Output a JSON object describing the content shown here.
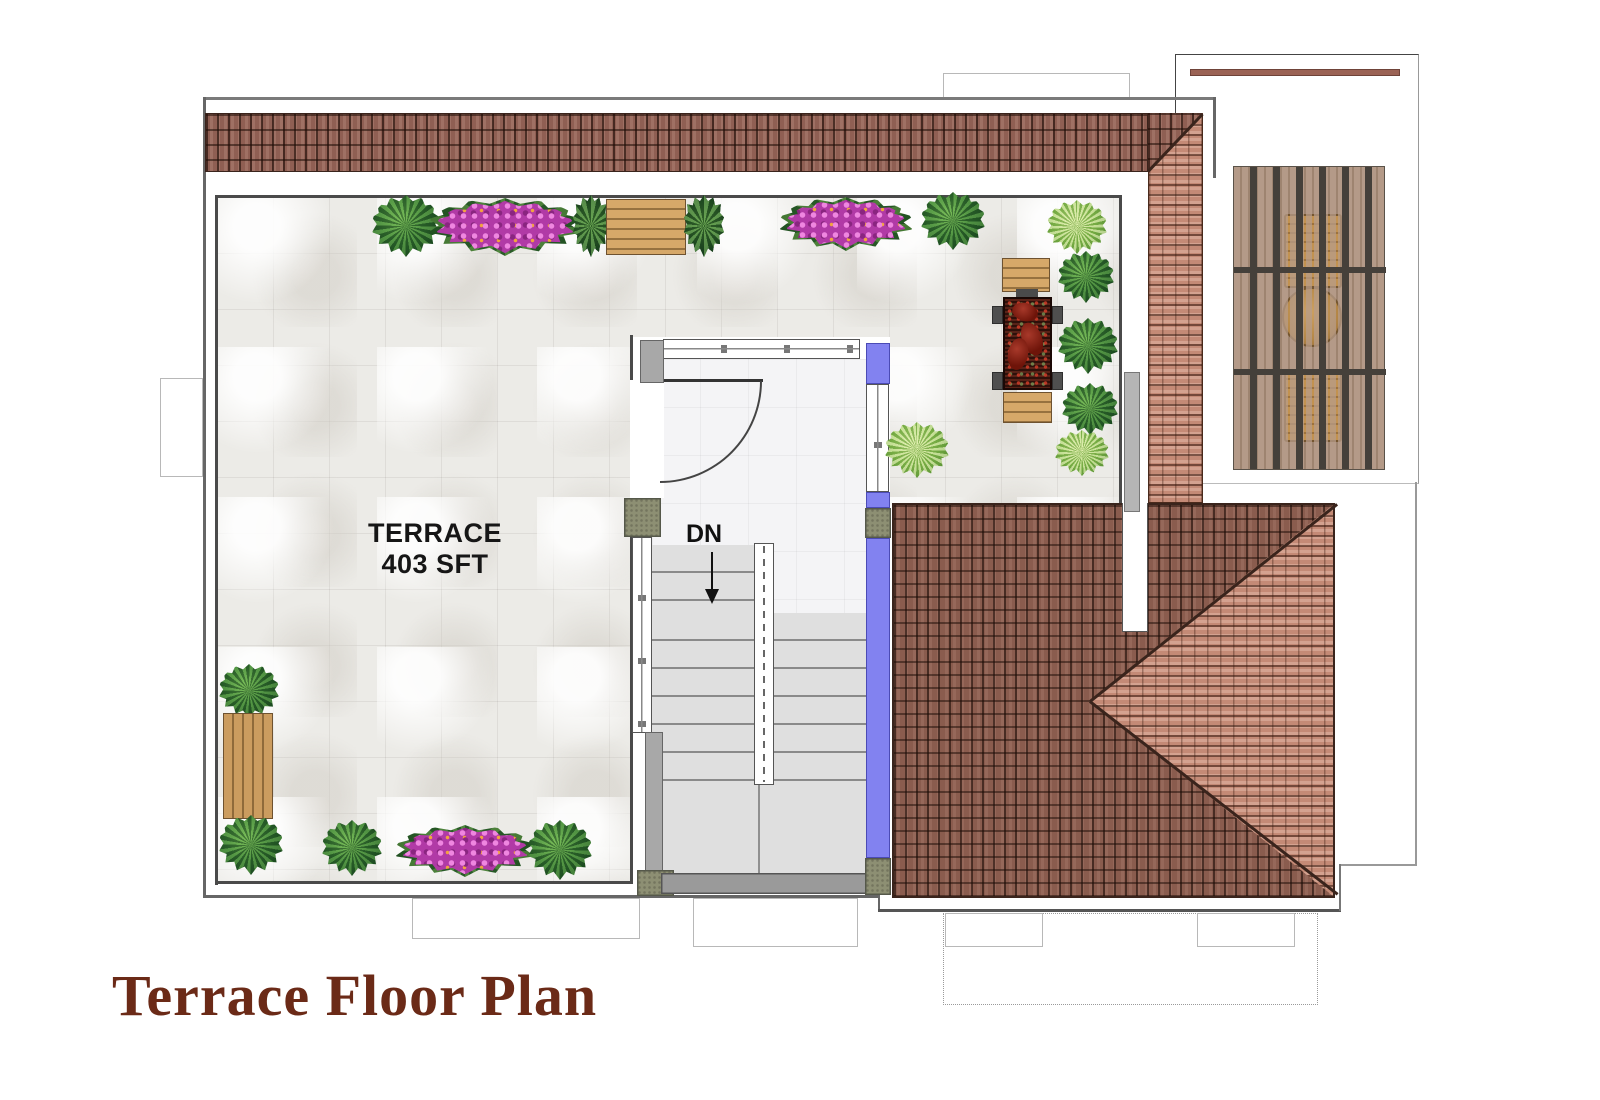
{
  "labels": {
    "title": "Terrace Floor Plan",
    "terrace_name": "TERRACE",
    "terrace_area": "403 SFT",
    "stair_direction": "DN"
  },
  "colors": {
    "title": "#6b2a17",
    "purple": "#8282f0",
    "roof_dark_tile": "#8a5c4e",
    "roof_light_tile": "#c48a76",
    "roof_band": "#8f5f53",
    "olive_pillar": "#8d8f73",
    "wood": "#cb9c5f",
    "flower": "#b13aa6",
    "plant_dark": "#3f8038",
    "plant_light": "#8fc04f",
    "marble_floor": "#ecebe7",
    "table_top": "#2e100a"
  },
  "garden": {
    "plants": [
      {
        "type": "bush",
        "x": 406,
        "y": 226,
        "w": 68,
        "h": 62
      },
      {
        "type": "flowers",
        "x": 505,
        "y": 227,
        "w": 154,
        "h": 58
      },
      {
        "type": "planter",
        "x": 591,
        "y": 226,
        "w": 36,
        "h": 62
      },
      {
        "type": "bench-h",
        "x": 646,
        "y": 227,
        "w": 80,
        "h": 56
      },
      {
        "type": "planter",
        "x": 704,
        "y": 226,
        "w": 40,
        "h": 62
      },
      {
        "type": "flowers",
        "x": 846,
        "y": 224,
        "w": 134,
        "h": 54
      },
      {
        "type": "bush",
        "x": 953,
        "y": 221,
        "w": 64,
        "h": 58
      },
      {
        "type": "fern",
        "x": 1077,
        "y": 227,
        "w": 60,
        "h": 54
      },
      {
        "type": "bush",
        "x": 1086,
        "y": 277,
        "w": 56,
        "h": 52
      },
      {
        "type": "bush",
        "x": 1088,
        "y": 346,
        "w": 60,
        "h": 56
      },
      {
        "type": "bush",
        "x": 1090,
        "y": 409,
        "w": 56,
        "h": 52
      },
      {
        "type": "fern",
        "x": 1082,
        "y": 453,
        "w": 54,
        "h": 46
      },
      {
        "type": "fern",
        "x": 917,
        "y": 450,
        "w": 64,
        "h": 56
      },
      {
        "type": "bush",
        "x": 249,
        "y": 691,
        "w": 60,
        "h": 54
      },
      {
        "type": "bench-v",
        "x": 248,
        "y": 766,
        "w": 50,
        "h": 106
      },
      {
        "type": "bush",
        "x": 251,
        "y": 845,
        "w": 64,
        "h": 60
      },
      {
        "type": "bush",
        "x": 352,
        "y": 848,
        "w": 60,
        "h": 56
      },
      {
        "type": "flowers",
        "x": 465,
        "y": 851,
        "w": 140,
        "h": 52
      },
      {
        "type": "bush",
        "x": 560,
        "y": 850,
        "w": 64,
        "h": 60
      }
    ]
  }
}
